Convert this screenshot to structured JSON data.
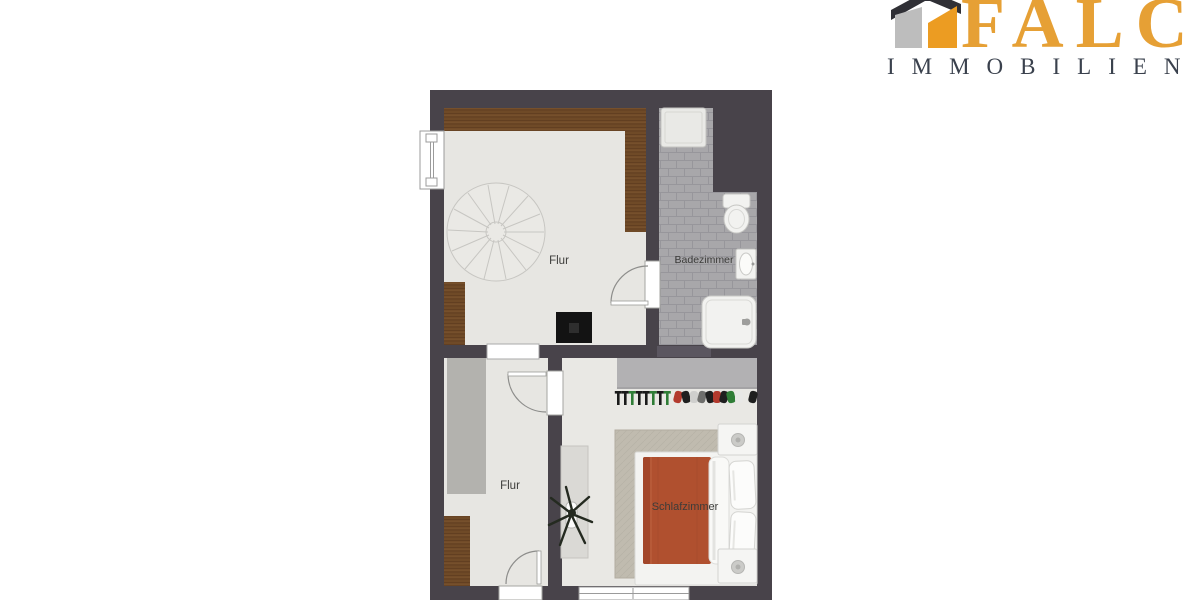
{
  "logo": {
    "brand": "FALC",
    "subtitle": "IMMOBILIEN",
    "brand_color": "#e6a035",
    "subtitle_color": "#3a414d",
    "icon_colors": {
      "roof": "#303036",
      "left_face": "#bdbdbd",
      "right_face": "#ec9c22"
    }
  },
  "floorplan": {
    "rooms": [
      {
        "id": "flur-upper",
        "label": "Flur"
      },
      {
        "id": "badezimmer",
        "label": "Badezimmer"
      },
      {
        "id": "flur-lower",
        "label": "Flur"
      },
      {
        "id": "schlafzimmer",
        "label": "Schlafzimmer"
      }
    ],
    "palette": {
      "wall": "#48434a",
      "floor": "#e7e6e2",
      "tile": "#a8a7aa",
      "wood": "#6f4a27",
      "bed_duvet": "#b0502f",
      "rug": "#c0bbaf",
      "wardrobe": "#b2b1b3",
      "cabinet": "#b3b2ae"
    },
    "rail_items": [
      {
        "x": 617,
        "c": "#1a1a1a",
        "t": "hanger"
      },
      {
        "x": 624,
        "c": "#1a1a1a",
        "t": "hanger"
      },
      {
        "x": 631,
        "c": "#2f7d36",
        "t": "hanger"
      },
      {
        "x": 638,
        "c": "#1a1a1a",
        "t": "hanger"
      },
      {
        "x": 645,
        "c": "#1a1a1a",
        "t": "hanger"
      },
      {
        "x": 652,
        "c": "#2f7d36",
        "t": "hanger"
      },
      {
        "x": 659,
        "c": "#1a1a1a",
        "t": "hanger"
      },
      {
        "x": 666,
        "c": "#2f7d36",
        "t": "hanger"
      },
      {
        "x": 674,
        "c": "#b33a2d",
        "t": "blob"
      },
      {
        "x": 682,
        "c": "#1f1f1f",
        "t": "blob"
      },
      {
        "x": 690,
        "c": "#cfcfcd",
        "t": "blob"
      },
      {
        "x": 698,
        "c": "#6e6e6c",
        "t": "blob"
      },
      {
        "x": 706,
        "c": "#1f1f1f",
        "t": "blob"
      },
      {
        "x": 713,
        "c": "#b33a2d",
        "t": "blob"
      },
      {
        "x": 720,
        "c": "#1f1f1f",
        "t": "blob"
      },
      {
        "x": 727,
        "c": "#2f7d36",
        "t": "blob"
      },
      {
        "x": 735,
        "c": "#e8e8e6",
        "t": "blob"
      },
      {
        "x": 749,
        "c": "#1f1f1f",
        "t": "blob"
      }
    ]
  }
}
